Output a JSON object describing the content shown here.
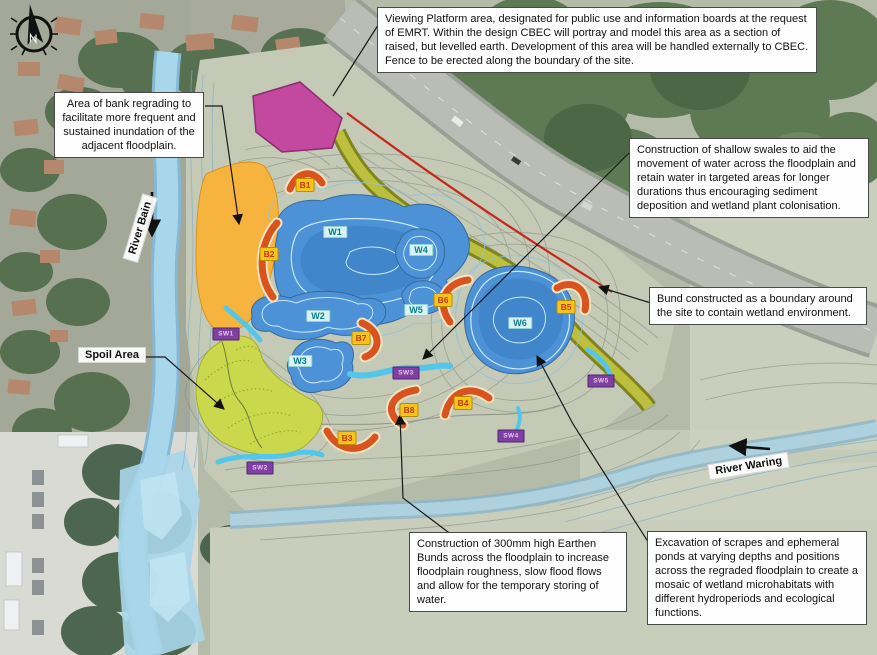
{
  "labels": {
    "river_bain": "River Bain",
    "river_waring": "River Waring",
    "spoil_area": "Spoil Area"
  },
  "callouts": {
    "viewing_platform": "Viewing Platform area, designated for public use and information boards at the request of EMRT. Within the design CBEC will portray and model this area as a section of raised, but levelled earth. Development of this area will be handled externally to CBEC. Fence to be erected along the boundary of the site.",
    "bank_regrading": "Area of bank regrading to facilitate more frequent and sustained inundation of the adjacent floodplain.",
    "swales": "Construction of shallow swales to aid the movement of water across the floodplain and retain water in targeted areas for longer durations thus encouraging sediment deposition and wetland plant colonisation.",
    "bund_boundary": "Bund constructed as a boundary around the site to contain wetland environment.",
    "earthen_bunds": "Construction of 300mm high Earthen Bunds across the floodplain to increase floodplain roughness, slow flood flows and allow for the temporary storing of water.",
    "scrapes": "Excavation of scrapes and ephemeral ponds at varying depths and positions across the regraded floodplain to create a mosaic of wetland microhabitats with different hydroperiods and ecological functions."
  },
  "markers": {
    "bunds": [
      "B1",
      "B2",
      "B3",
      "B4",
      "B5",
      "B6",
      "B7",
      "B8"
    ],
    "wetlands": [
      "W1",
      "W2",
      "W3",
      "W4",
      "W5",
      "W6"
    ],
    "swales": [
      "SW1",
      "SW2",
      "SW3",
      "SW4",
      "SW5"
    ]
  },
  "icons": {
    "compass": "north-arrow-compass"
  },
  "colors": {
    "viewing_platform_area": "#c2499e",
    "bank_regrading_area": "#f6b43e",
    "boundary_bund": "#bcc03e",
    "site_boundary_line": "#c5271d",
    "pond_blue": "#4d92d6",
    "earthen_bund_arc": "#d8531e",
    "swale_channel": "#54c6ea",
    "spoil_area": "#ccd84c",
    "bund_badge": "#f8c41c",
    "swale_badge": "#8040a2",
    "wetland_label": "#0b7c8c"
  }
}
